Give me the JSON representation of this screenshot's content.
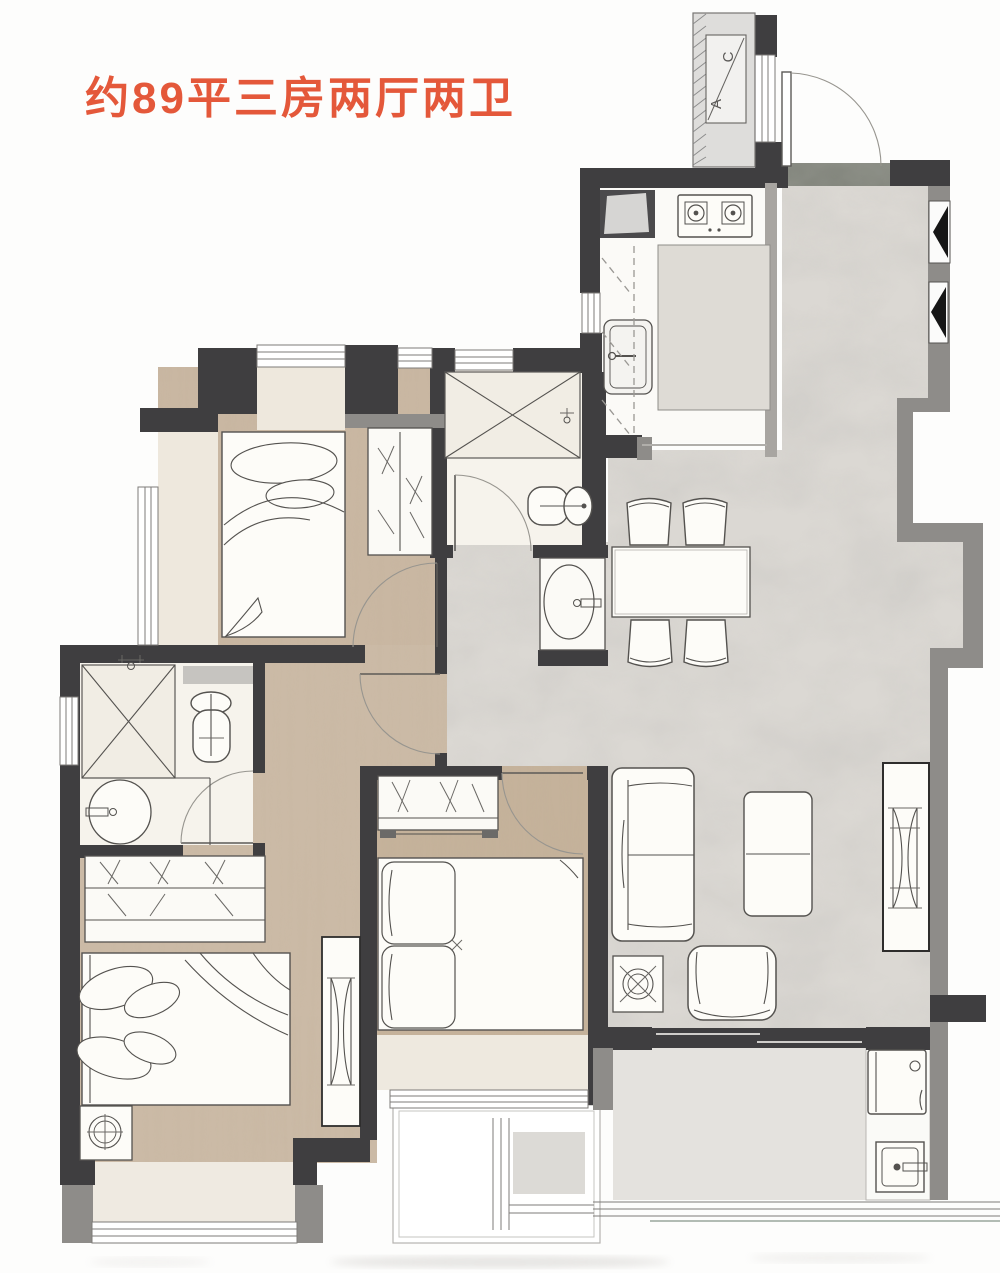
{
  "title": {
    "text": "约89平三房两厅两卫",
    "color": "#e4583a"
  },
  "duct_shaft": {
    "label_c": "C",
    "label_a": "A"
  },
  "palette": {
    "accent_orange": "#e4583a",
    "wall_dark": "#3f3e40",
    "wall_gray": "#8e8c89",
    "wood_floor": "#c9b7a2",
    "marble_floor": "#dbd8d3",
    "bath_tile": "#f6f3ec",
    "bay_sill": "#eee8dd",
    "balcony_floor": "#e4e2de",
    "entry_threshold": "#83867d"
  }
}
